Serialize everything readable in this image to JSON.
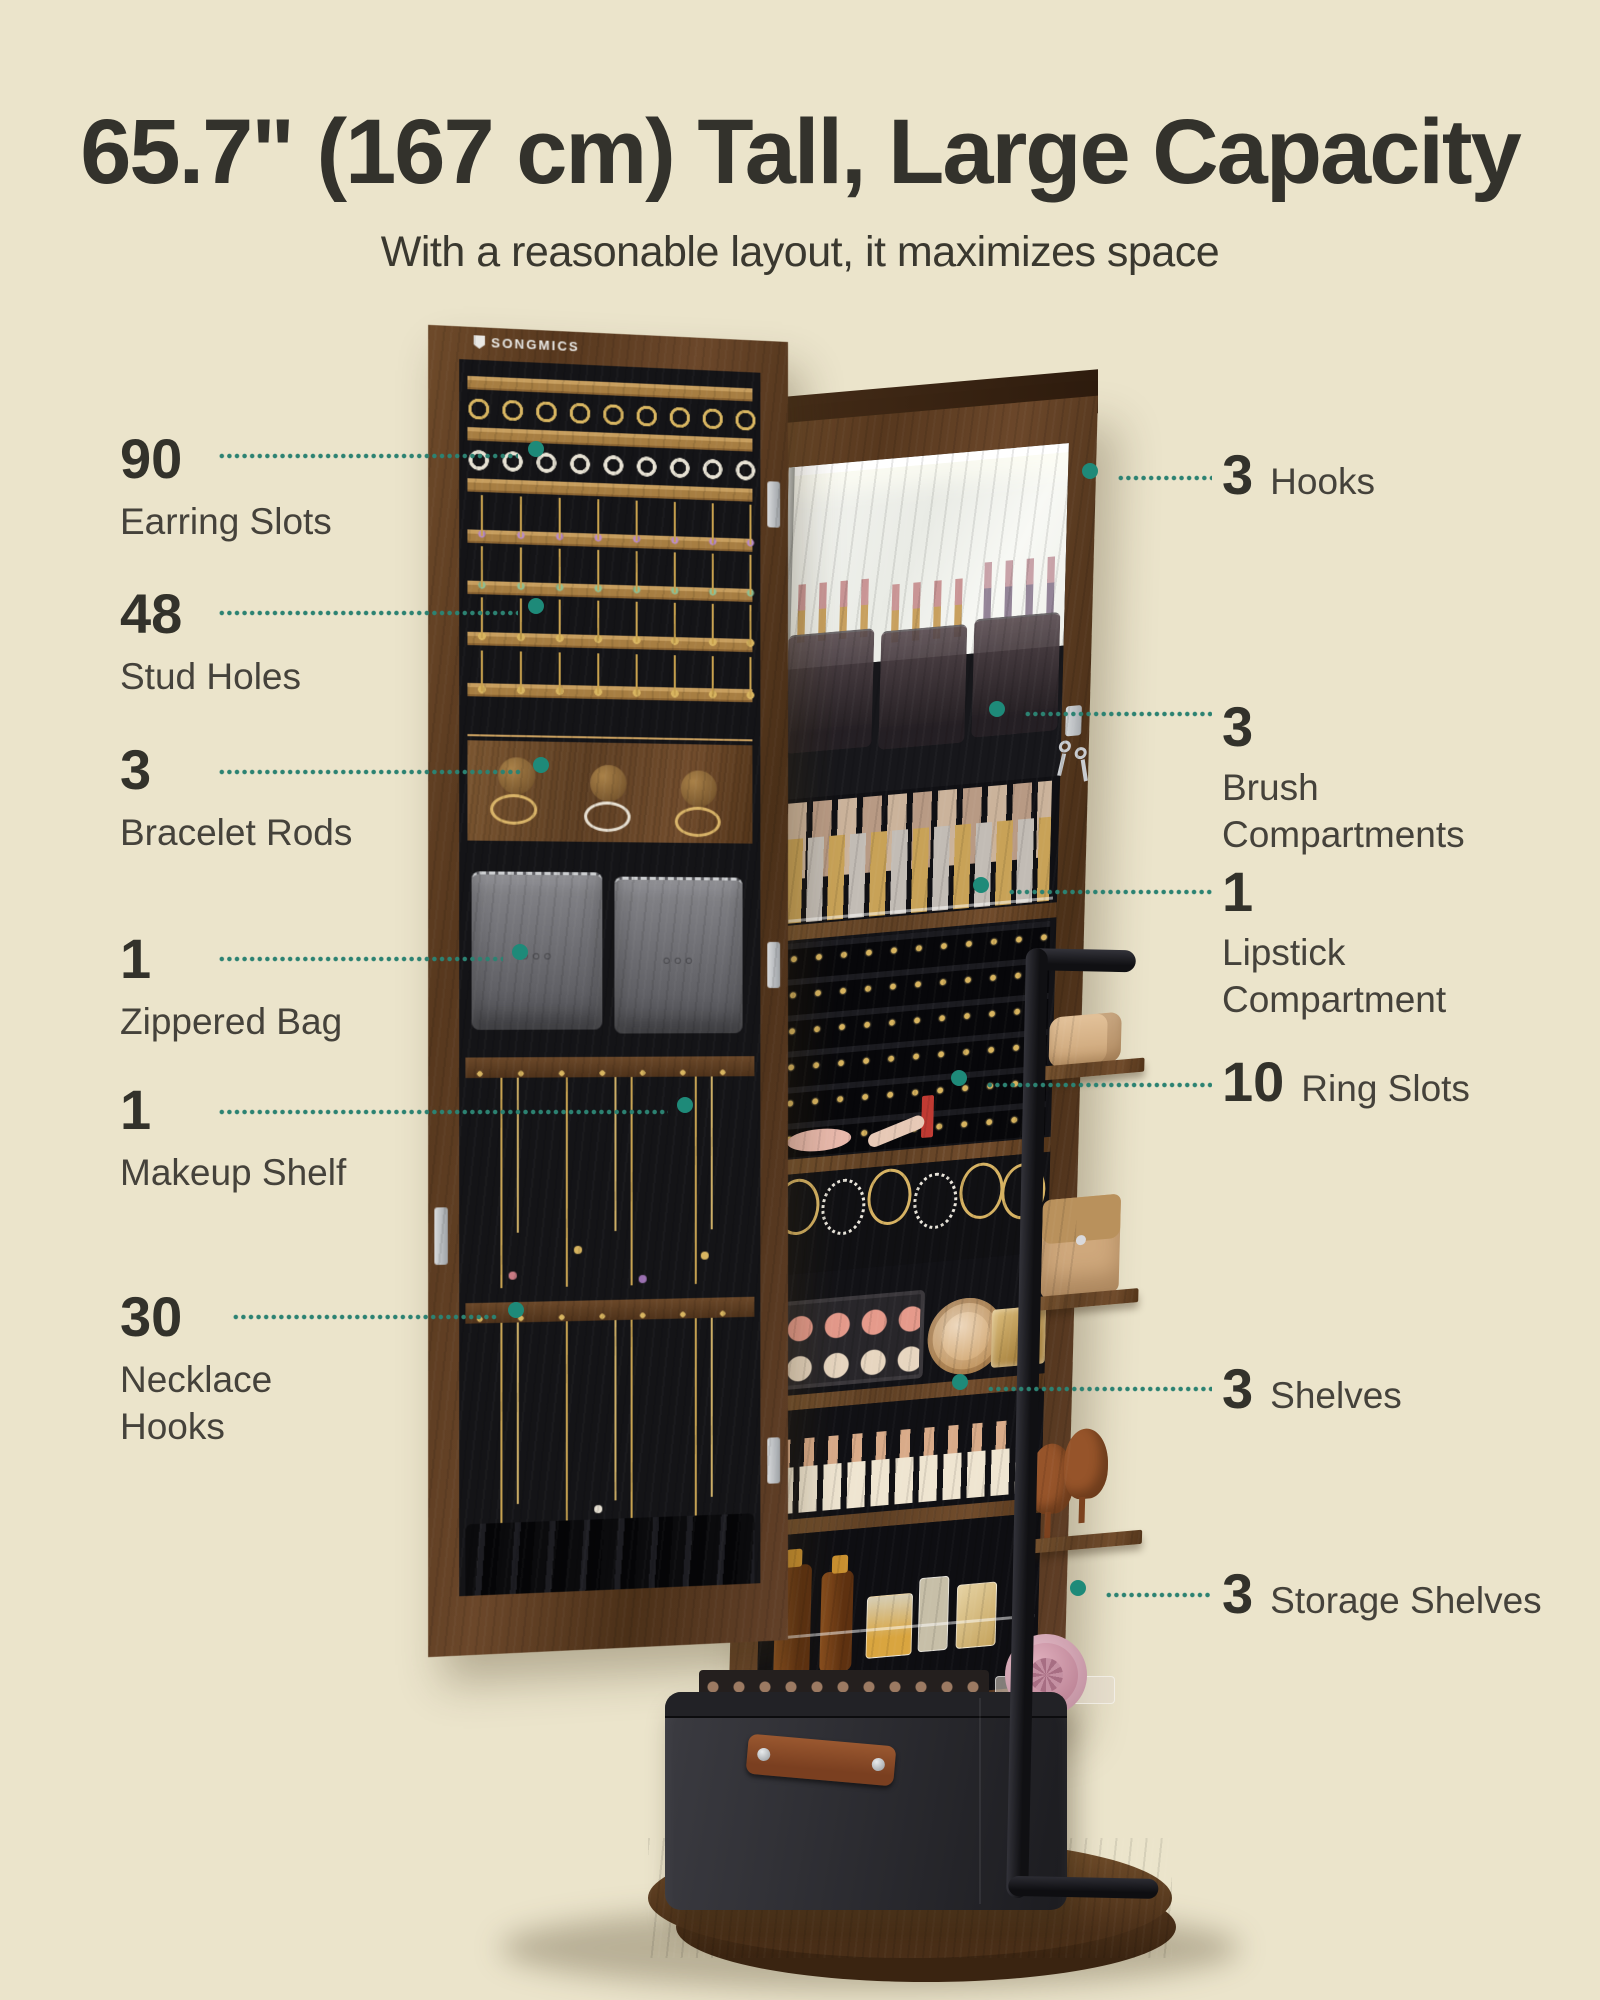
{
  "header": {
    "title": "65.7\" (167 cm) Tall, Large Capacity",
    "subtitle": "With a reasonable layout, it maximizes space"
  },
  "brand": {
    "logo": "SONGMICS"
  },
  "theme": {
    "background": "#EBE4CB",
    "accent_teal": "#2C8272",
    "endpoint_fill": "#BEE3DA",
    "heading_text": "#33322C",
    "label_text": "#45423B",
    "wood_brown": "#5E3F23",
    "felt_black": "#141417"
  },
  "callouts": {
    "left": [
      {
        "value": "90",
        "label": "Earring Slots"
      },
      {
        "value": "48",
        "label": "Stud Holes"
      },
      {
        "value": "3",
        "label": "Bracelet Rods"
      },
      {
        "value": "1",
        "label": "Zippered Bag"
      },
      {
        "value": "1",
        "label": "Makeup Shelf"
      },
      {
        "value": "30",
        "label": "Necklace Hooks"
      }
    ],
    "right": [
      {
        "value": "3",
        "label": "Hooks"
      },
      {
        "value": "3",
        "label": "Brush Compartments"
      },
      {
        "value": "1",
        "label": "Lipstick Compartment"
      },
      {
        "value": "10",
        "label": "Ring Slots"
      },
      {
        "value": "3",
        "label": "Shelves"
      },
      {
        "value": "3",
        "label": "Storage Shelves"
      }
    ]
  }
}
